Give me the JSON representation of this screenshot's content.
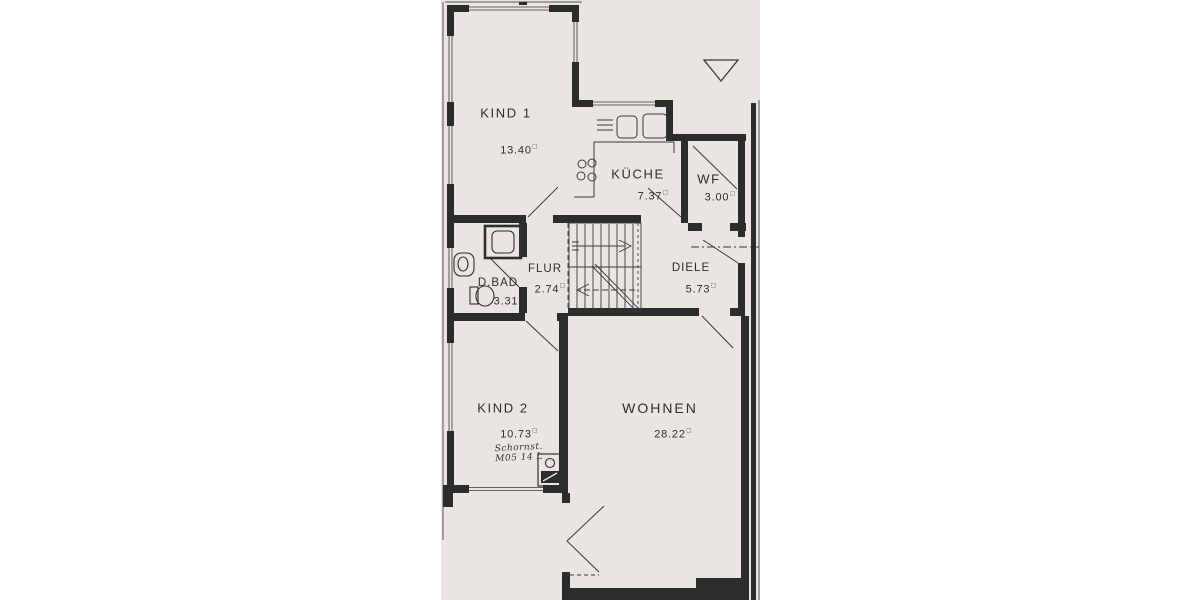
{
  "canvas": {
    "background": "#ffffff"
  },
  "paper": {
    "color": "#e9e6e1",
    "ink": "#2c2c2c"
  },
  "plan": {
    "area_unit_symbol": "□",
    "rooms": [
      {
        "key": "kind1",
        "name": "KIND 1",
        "area": "13.40"
      },
      {
        "key": "kueche",
        "name": "KÜCHE",
        "area": "7.37"
      },
      {
        "key": "wf",
        "name": "WF",
        "area": "3.00"
      },
      {
        "key": "flur",
        "name": "FLUR",
        "area": "2.74"
      },
      {
        "key": "diele",
        "name": "DIELE",
        "area": "5.73"
      },
      {
        "key": "dbad",
        "name": "D.BAD",
        "area": "3.31"
      },
      {
        "key": "kind2",
        "name": "KIND 2",
        "area": "10.73"
      },
      {
        "key": "wohnen",
        "name": "WOHNEN",
        "area": "28.22"
      }
    ],
    "annotations": {
      "chimney_note_line1": "Schornst.",
      "chimney_note_line2": "M05 14 L"
    }
  }
}
